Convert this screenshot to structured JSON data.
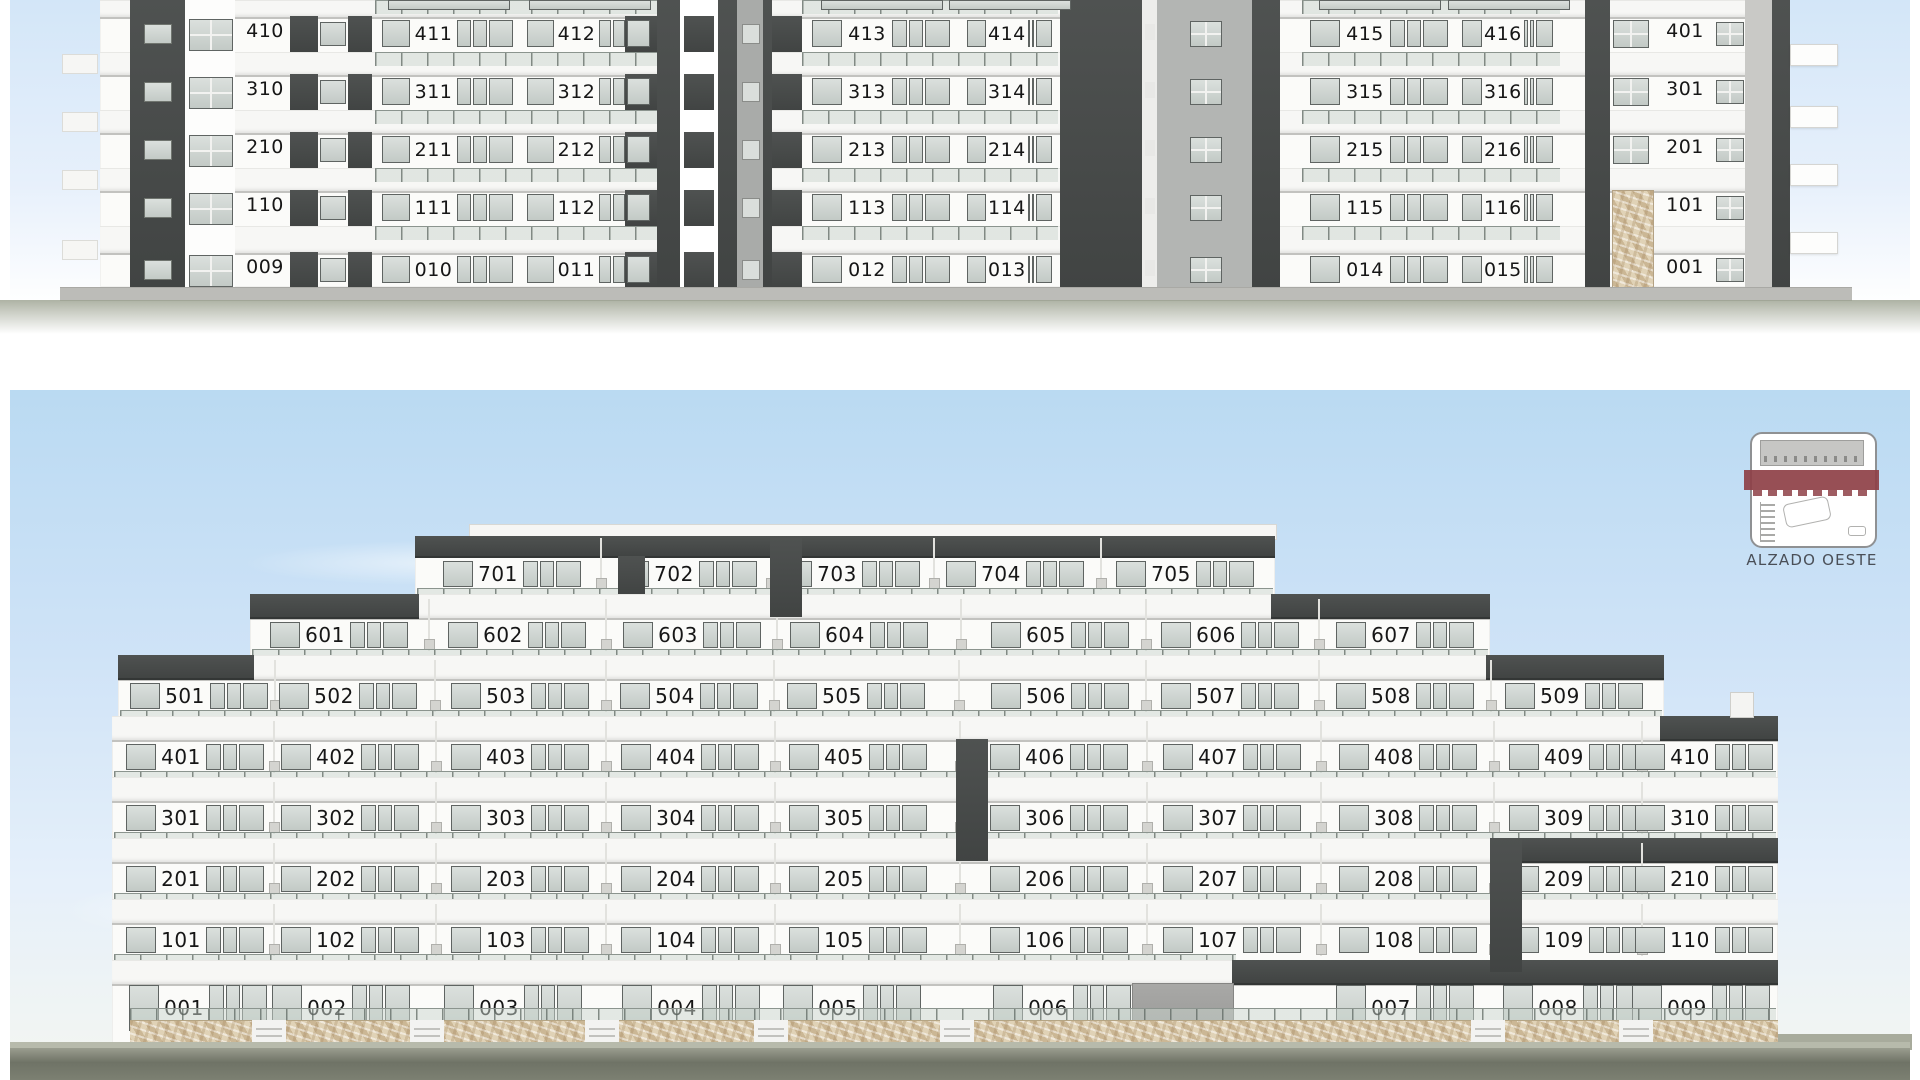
{
  "top_elevation": {
    "rows": [
      [
        "410",
        "411",
        "412",
        "413",
        "414",
        "415",
        "416",
        "401"
      ],
      [
        "310",
        "311",
        "312",
        "313",
        "314",
        "315",
        "316",
        "301"
      ],
      [
        "210",
        "211",
        "212",
        "213",
        "214",
        "215",
        "216",
        "201"
      ],
      [
        "110",
        "111",
        "112",
        "113",
        "114",
        "115",
        "116",
        "101"
      ],
      [
        "009",
        "010",
        "011",
        "012",
        "013",
        "014",
        "015",
        "001"
      ]
    ]
  },
  "west_elevation": {
    "caption": "ALZADO OESTE",
    "floors": [
      [
        "701",
        "702",
        "703",
        "704",
        "705"
      ],
      [
        "601",
        "602",
        "603",
        "604",
        "605",
        "606",
        "607"
      ],
      [
        "501",
        "502",
        "503",
        "504",
        "505",
        "506",
        "507",
        "508",
        "509"
      ],
      [
        "401",
        "402",
        "403",
        "404",
        "405",
        "406",
        "407",
        "408",
        "409",
        "410"
      ],
      [
        "301",
        "302",
        "303",
        "304",
        "305",
        "306",
        "307",
        "308",
        "309",
        "310"
      ],
      [
        "201",
        "202",
        "203",
        "204",
        "205",
        "206",
        "207",
        "208",
        "209",
        "210"
      ],
      [
        "101",
        "102",
        "103",
        "104",
        "105",
        "106",
        "107",
        "108",
        "109",
        "110"
      ],
      [
        "001",
        "002",
        "003",
        "004",
        "005",
        "006",
        "007",
        "008",
        "009"
      ]
    ]
  },
  "colors": {
    "sky_top": "#cfe4f8",
    "sky_deep": "#badaf2",
    "dark_band": "#474a49",
    "slab_white": "#f7f7f5",
    "facade": "#fbfbf9",
    "glass": "#c9d1cd",
    "frame": "#5f6462",
    "stone": "#d6c5a7",
    "ground_dark": "#6f7368",
    "ground_gray": "#bcbcb8",
    "keymap_accent": "#8e4046",
    "label_ink": "#161616"
  }
}
